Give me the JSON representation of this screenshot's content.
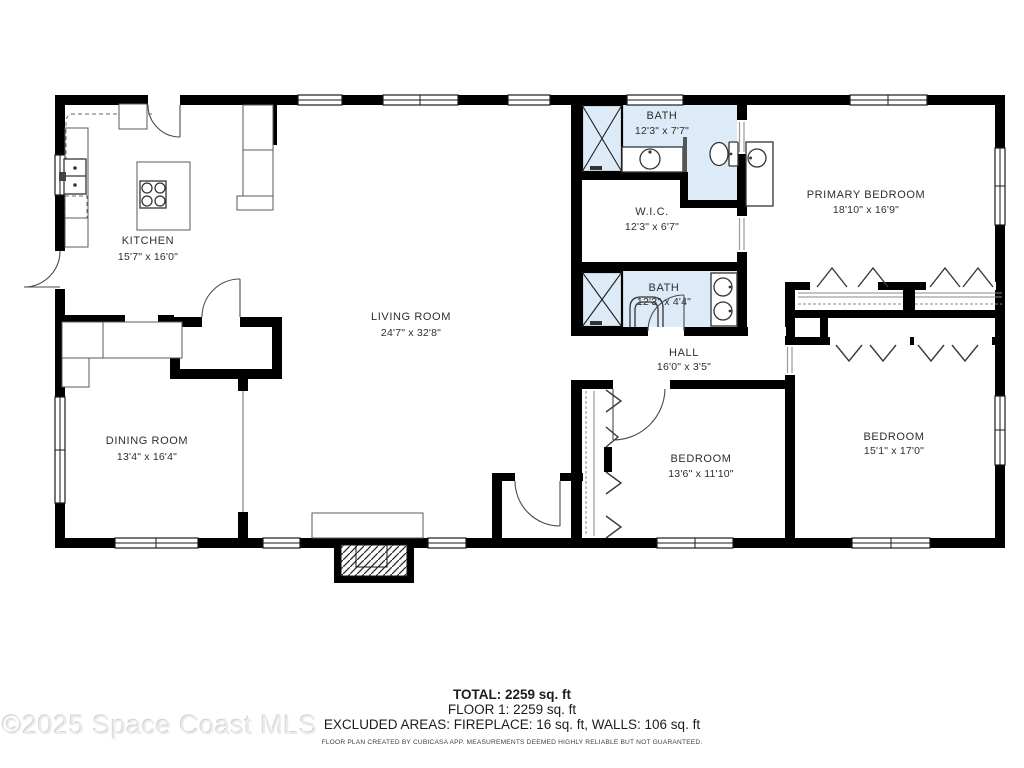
{
  "watermark": "©2025 Space Coast MLS",
  "plan": {
    "rooms": [
      {
        "name": "KITCHEN",
        "dims": "15'7\" x 16'0\""
      },
      {
        "name": "LIVING ROOM",
        "dims": "24'7\" x 32'8\""
      },
      {
        "name": "DINING ROOM",
        "dims": "13'4\" x 16'4\""
      },
      {
        "name": "BATH",
        "dims": "12'3\" x 7'7\""
      },
      {
        "name": "W.I.C.",
        "dims": "12'3\" x 6'7\""
      },
      {
        "name": "PRIMARY BEDROOM",
        "dims": "18'10\" x 16'9\""
      },
      {
        "name": "BATH",
        "dims": "12'3\" x 4'4\""
      },
      {
        "name": "HALL",
        "dims": "16'0\" x 3'5\""
      },
      {
        "name": "BEDROOM",
        "dims": "13'6\" x 11'10\""
      },
      {
        "name": "BEDROOM",
        "dims": "15'1\" x 17'0\""
      }
    ]
  },
  "summary": {
    "total": "TOTAL: 2259 sq. ft",
    "floor": "FLOOR 1: 2259 sq. ft",
    "excluded": "EXCLUDED AREAS: FIREPLACE: 16 sq. ft, WALLS: 106 sq. ft",
    "disclaimer": "FLOOR PLAN CREATED BY CUBICASA APP. MEASUREMENTS DEEMED HIGHLY RELIABLE BUT NOT GUARANTEED."
  },
  "colors": {
    "wall": "#000000",
    "bath_fill": "#dcebf7",
    "watermark_gray": "#ebebeb"
  }
}
